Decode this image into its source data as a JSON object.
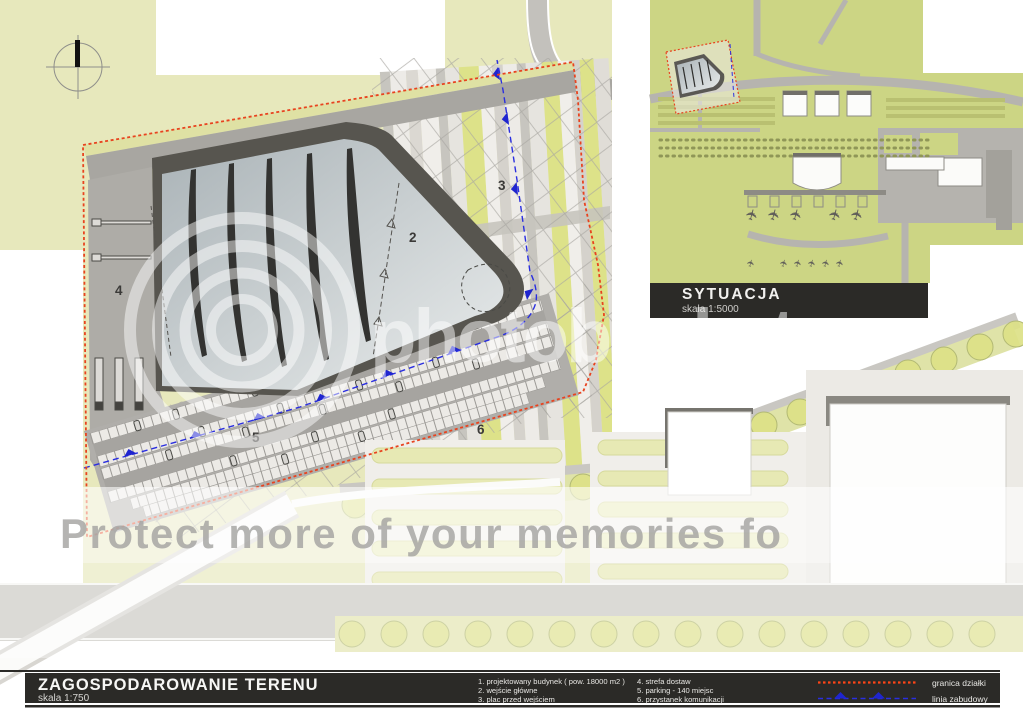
{
  "title_bar": {
    "title": "ZAGOSPODAROWANIE TERENU",
    "scale": "skala 1:750"
  },
  "inset": {
    "title": "SYTUACJA",
    "scale": "skala 1:5000"
  },
  "legend": {
    "col1": [
      "1. projektowany budynek ( pow. 18000 m2 )",
      "2. wejście główne",
      "3. plac przed wejściem"
    ],
    "col2": [
      "4. strefa dostaw",
      "5. parking - 140 miejsc",
      "6. przystanek komunikacji"
    ],
    "lines": [
      {
        "label": "granica działki",
        "color": "#e8431f",
        "style": "dashed-red"
      },
      {
        "label": "linia zabudowy",
        "color": "#2a2ee0",
        "style": "dashed-blue-triangles"
      }
    ]
  },
  "plan": {
    "labels": [
      {
        "text": "2"
      },
      {
        "text": "3"
      },
      {
        "text": "4"
      },
      {
        "text": "5"
      },
      {
        "text": "6"
      }
    ]
  },
  "watermark": {
    "brand": "photobucket",
    "tagline": "Protect more of your memories fo"
  },
  "icons": {
    "airplane": "✈"
  },
  "colors": {
    "plot_boundary_red": "#e8431f",
    "building_line_blue": "#2a2ee0",
    "greenery": "#e7e8bc",
    "inset_greenery": "#ccd584",
    "dark_bar": "#2b2a27",
    "building_dark": "#57554f"
  }
}
